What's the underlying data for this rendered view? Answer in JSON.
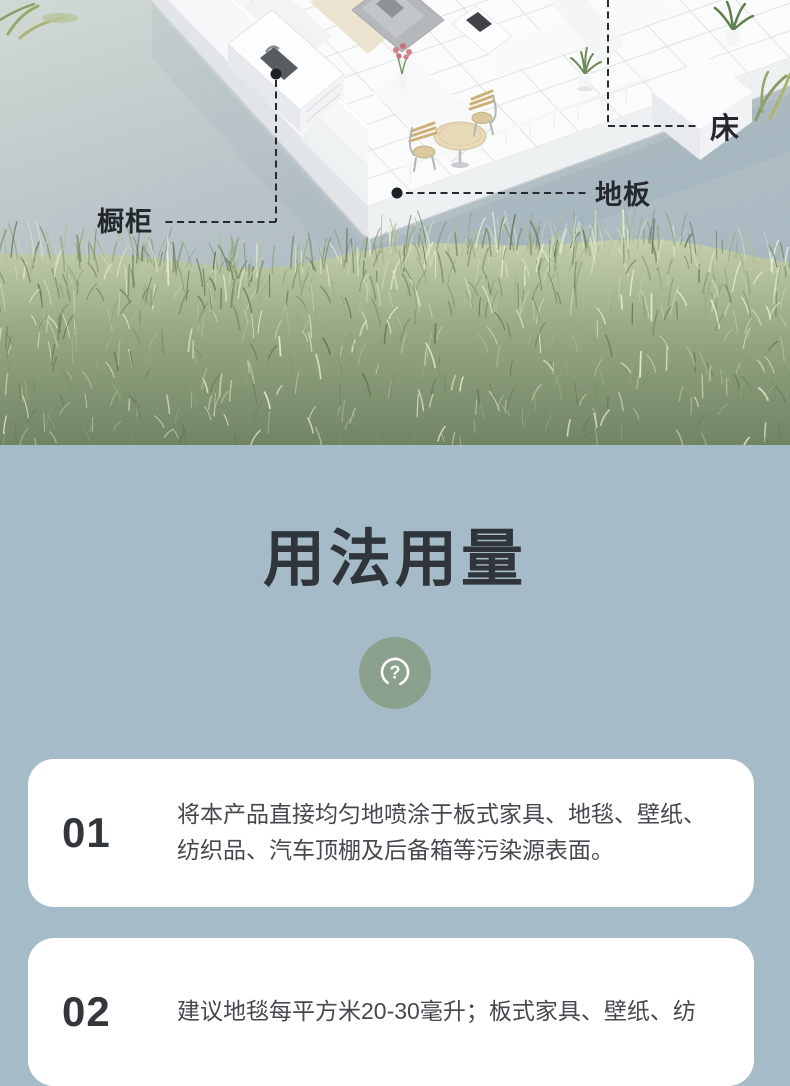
{
  "hero": {
    "description": "isometric-apartment-model-on-water-with-grass",
    "callouts": [
      {
        "id": "bed",
        "label": "床"
      },
      {
        "id": "floor",
        "label": "地板"
      },
      {
        "id": "cabinet",
        "label": "橱柜"
      }
    ]
  },
  "usage": {
    "title": "用法用量",
    "icon": "question-icon",
    "steps": [
      {
        "number": "01",
        "text": "将本产品直接均匀地喷涂于板式家具、地毯、壁纸、纺织品、汽车顶棚及后备箱等污染源表面。"
      },
      {
        "number": "02",
        "text": "建议地毯每平方米20-30毫升；板式家具、壁纸、纺"
      }
    ]
  },
  "colors": {
    "bg": "#a6bbc8",
    "card": "#ffffff",
    "title": "#2f353a",
    "text": "#45494e",
    "number": "#33373b",
    "badge": "#8ba18e",
    "callout": "#24282c"
  }
}
